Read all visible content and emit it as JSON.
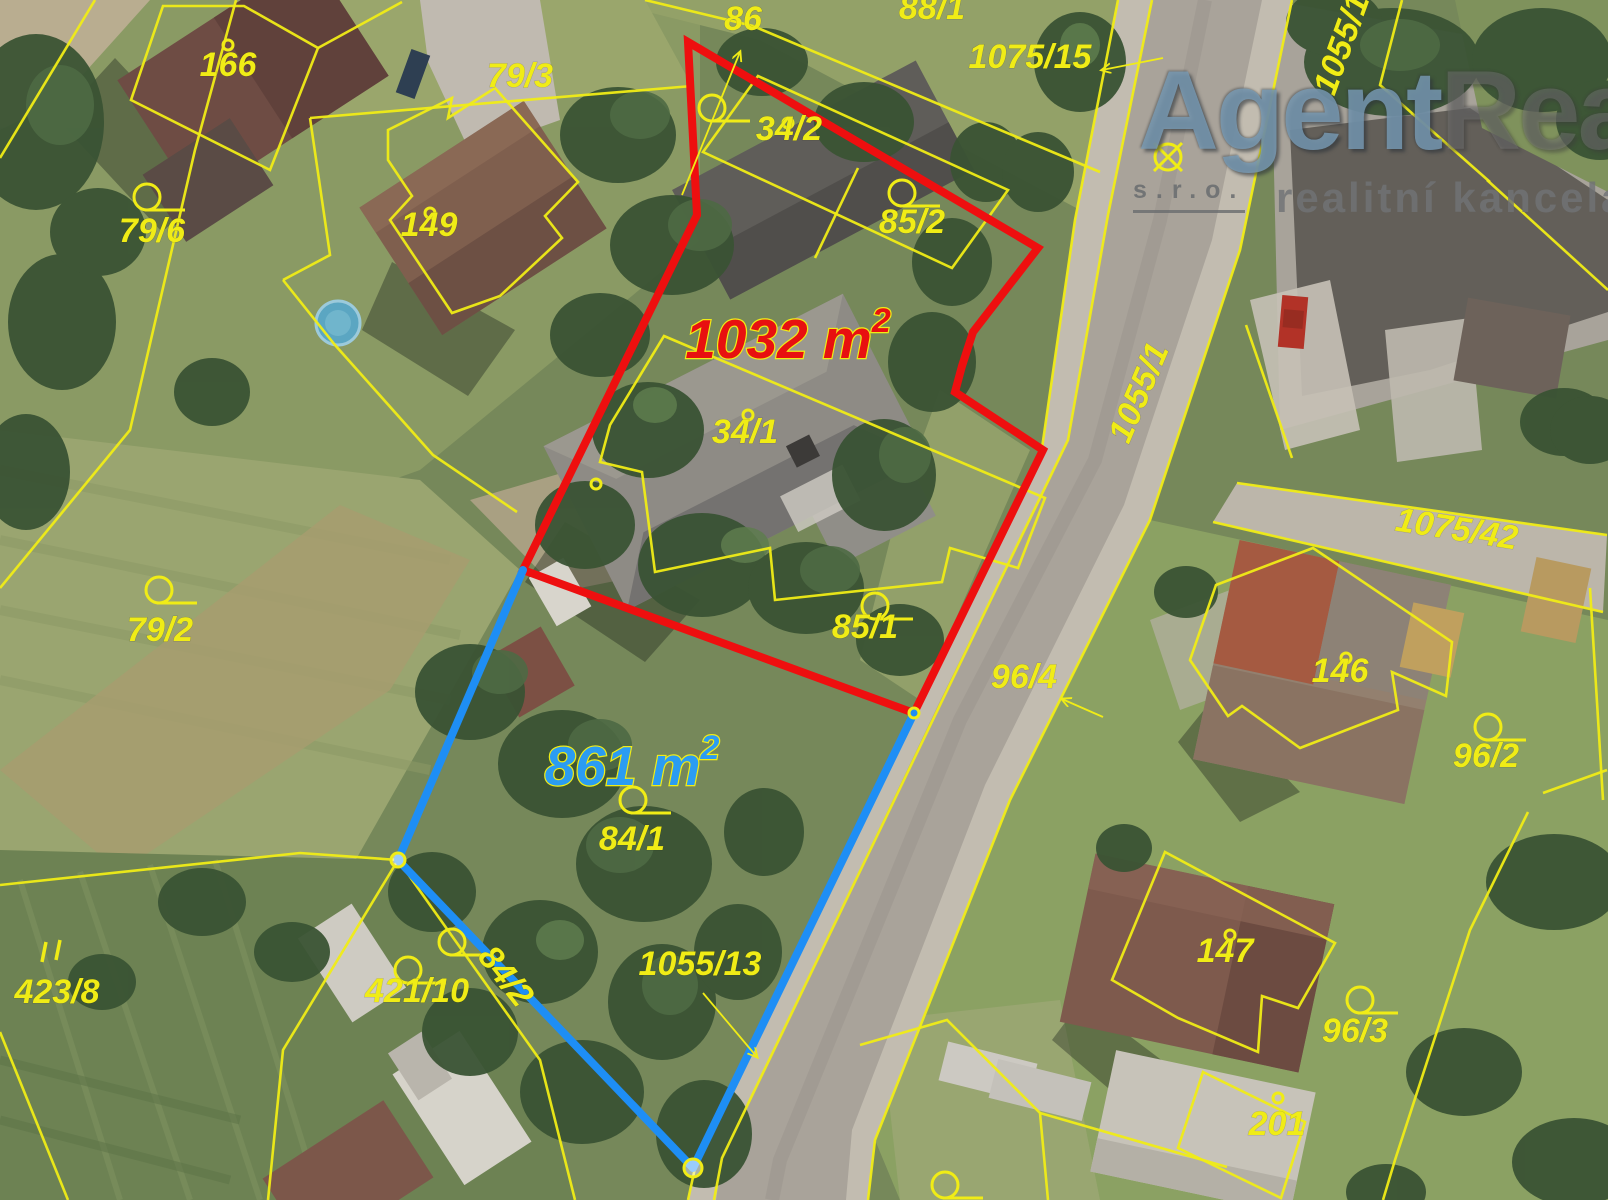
{
  "watermark": {
    "brand_part1": "Agent",
    "brand_part2": "Real",
    "suffix": "s.r.o.",
    "tagline": "realitní kancelář"
  },
  "map": {
    "width": 1608,
    "height": 1200,
    "colors": {
      "cadastral_line": "#f0ec16",
      "red_boundary": "#ee0f0f",
      "blue_boundary": "#1e8ef5",
      "red_area_text": "#e81010",
      "blue_area_text": "#2b9cf2"
    },
    "area_labels": [
      {
        "text": "1032 m",
        "sup": "2",
        "x": 788,
        "y": 358,
        "color": "#e81010"
      },
      {
        "text": "861 m",
        "sup": "2",
        "x": 632,
        "y": 785,
        "color": "#2b9cf2"
      }
    ],
    "labels": [
      {
        "text": "166",
        "x": 228,
        "y": 76
      },
      {
        "text": "79/3",
        "x": 520,
        "y": 87
      },
      {
        "text": "86",
        "x": 743,
        "y": 30
      },
      {
        "text": "88/1",
        "x": 932,
        "y": 19
      },
      {
        "text": "1075/15",
        "x": 1030,
        "y": 68
      },
      {
        "text": "34/2",
        "x": 789,
        "y": 140
      },
      {
        "text": "85/2",
        "x": 912,
        "y": 233
      },
      {
        "text": "79/6",
        "x": 152,
        "y": 242
      },
      {
        "text": "149",
        "x": 429,
        "y": 236
      },
      {
        "text": "34/1",
        "x": 745,
        "y": 443
      },
      {
        "text": "1055/1",
        "x": 1149,
        "y": 397,
        "rot": -67
      },
      {
        "text": "1075/42",
        "x": 1455,
        "y": 540,
        "rot": 9
      },
      {
        "text": "146",
        "x": 1340,
        "y": 682
      },
      {
        "text": "96/2",
        "x": 1486,
        "y": 767
      },
      {
        "text": "96/4",
        "x": 1024,
        "y": 688
      },
      {
        "text": "85/1",
        "x": 865,
        "y": 638
      },
      {
        "text": "79/2",
        "x": 160,
        "y": 641
      },
      {
        "text": "84/1",
        "x": 632,
        "y": 850
      },
      {
        "text": "423/8",
        "x": 57,
        "y": 1003
      },
      {
        "text": "421/10",
        "x": 417,
        "y": 1002
      },
      {
        "text": "84/2",
        "x": 497,
        "y": 983,
        "rot": 52
      },
      {
        "text": "1055/13",
        "x": 700,
        "y": 975
      },
      {
        "text": "147",
        "x": 1225,
        "y": 962
      },
      {
        "text": "96/3",
        "x": 1355,
        "y": 1042
      },
      {
        "text": "201",
        "x": 1277,
        "y": 1135
      },
      {
        "text": "1055/1",
        "x": 1352,
        "y": 48,
        "rot": -70
      }
    ],
    "markers": [
      {
        "x": 147,
        "y": 197
      },
      {
        "x": 902,
        "y": 193
      },
      {
        "x": 712,
        "y": 108
      },
      {
        "x": 159,
        "y": 590
      },
      {
        "x": 875,
        "y": 606
      },
      {
        "x": 633,
        "y": 800
      },
      {
        "x": 1488,
        "y": 727
      },
      {
        "x": 1360,
        "y": 1000
      },
      {
        "x": 408,
        "y": 970
      },
      {
        "x": 452,
        "y": 942
      },
      {
        "x": 945,
        "y": 1185
      },
      {
        "x": 1168,
        "y": 157,
        "type": "survey"
      }
    ],
    "dots": [
      {
        "x": 228,
        "y": 45
      },
      {
        "x": 430,
        "y": 213
      },
      {
        "x": 788,
        "y": 123
      },
      {
        "x": 748,
        "y": 415
      },
      {
        "x": 596,
        "y": 484
      },
      {
        "x": 1346,
        "y": 658
      },
      {
        "x": 1230,
        "y": 935
      },
      {
        "x": 1278,
        "y": 1098
      },
      {
        "x": 914,
        "y": 713
      }
    ],
    "arrows": [
      {
        "x1": 682,
        "y1": 195,
        "x2": 740,
        "y2": 52
      },
      {
        "x1": 1163,
        "y1": 58,
        "x2": 1102,
        "y2": 70
      },
      {
        "x1": 1103,
        "y1": 717,
        "x2": 1062,
        "y2": 699
      },
      {
        "x1": 703,
        "y1": 993,
        "x2": 757,
        "y2": 1057
      }
    ]
  }
}
